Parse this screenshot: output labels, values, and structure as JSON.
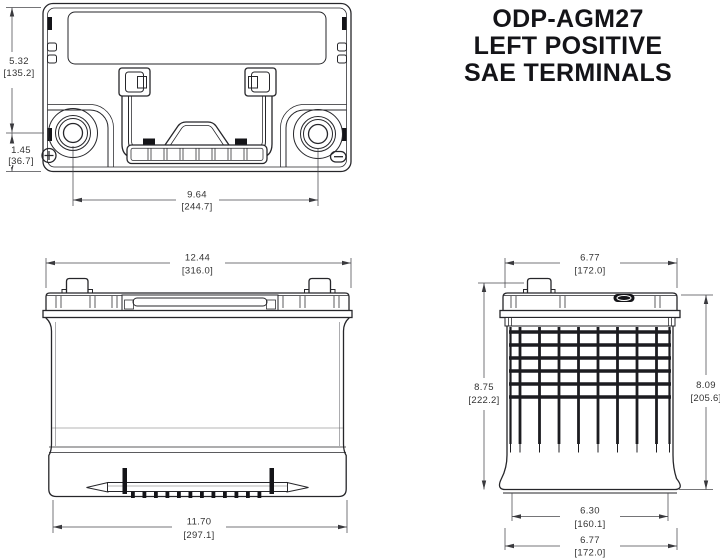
{
  "title": {
    "model": "ODP-AGM27",
    "polarity": "LEFT POSITIVE",
    "terminals": "SAE TERMINALS"
  },
  "top_view": {
    "overall_height_in": "5.32",
    "overall_height_mm": "[135.2]",
    "terminal_offset_in": "1.45",
    "terminal_offset_mm": "[36.7]",
    "terminal_spacing_in": "9.64",
    "terminal_spacing_mm": "[244.7]"
  },
  "front_view": {
    "overall_width_in": "12.44",
    "overall_width_mm": "[316.0]",
    "base_width_in": "11.70",
    "base_width_mm": "[297.1]"
  },
  "side_view": {
    "overall_depth_in": "6.77",
    "overall_depth_mm": "[172.0]",
    "total_height_in": "8.75",
    "total_height_mm": "[222.2]",
    "case_height_in": "8.09",
    "case_height_mm": "[205.6]",
    "base_depth_in": "6.30",
    "base_depth_mm": "[160.1]",
    "bottom_depth_in": "6.77",
    "bottom_depth_mm": "[172.0]"
  }
}
